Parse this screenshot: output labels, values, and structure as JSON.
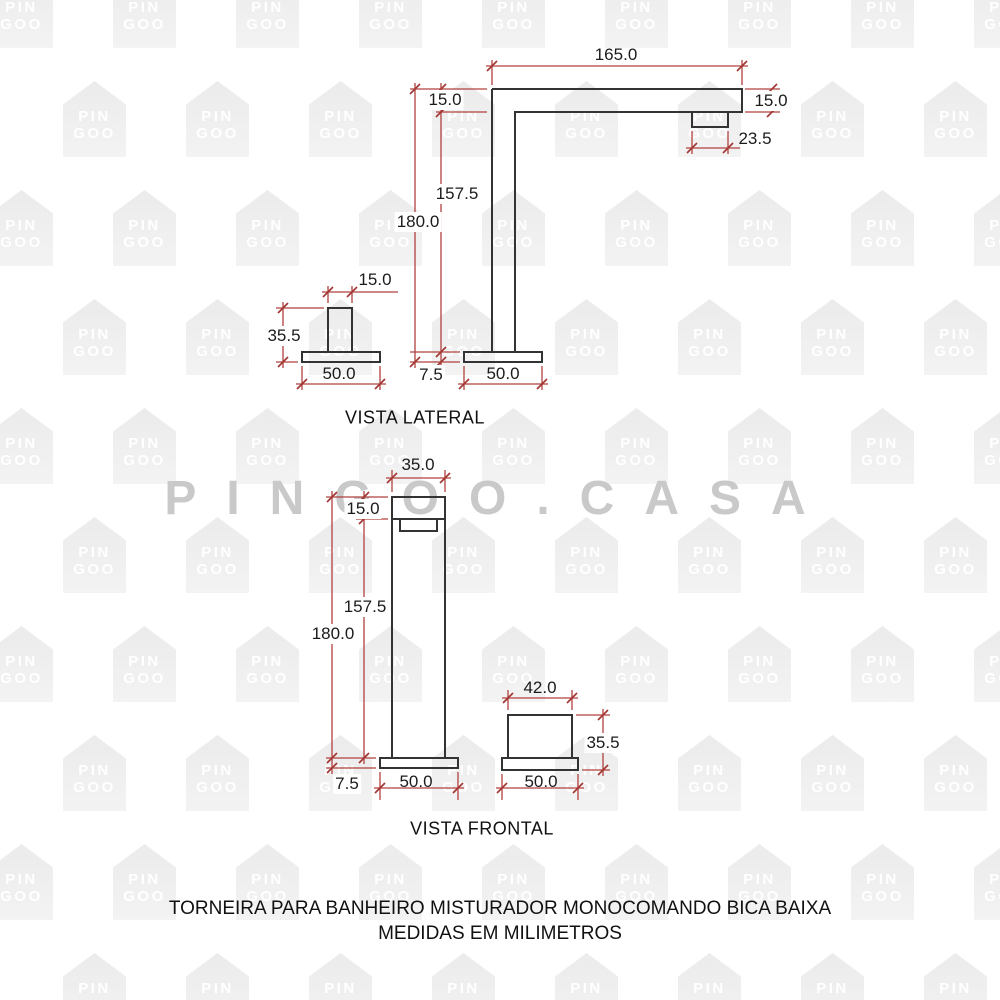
{
  "watermark": {
    "house_line1": "PIN",
    "house_line2": "GOO",
    "big_text": "PINGOO.CASA"
  },
  "lateral": {
    "title": "VISTA LATERAL",
    "dims": {
      "top_length": "165.0",
      "arm_thickness_left": "15.0",
      "arm_thickness_right": "15.0",
      "spout_length": "23.5",
      "height_inner": "157.5",
      "height_total": "180.0",
      "handle_width": "15.0",
      "handle_height": "35.5",
      "handle_base_width": "50.0",
      "base_height": "7.5",
      "base_width": "50.0"
    }
  },
  "frontal": {
    "title": "VISTA FRONTAL",
    "dims": {
      "body_width": "35.0",
      "top_section": "15.0",
      "height_inner": "157.5",
      "height_total": "180.0",
      "base_height": "7.5",
      "base_width": "50.0",
      "handle_width": "42.0",
      "handle_height": "35.5",
      "handle_base_width": "50.0"
    }
  },
  "footer": {
    "line1": "TORNEIRA PARA BANHEIRO MISTURADOR MONOCOMANDO BICA BAIXA",
    "line2": "MEDIDAS EM MILIMETROS"
  },
  "colors": {
    "outline": "#333333",
    "dimension_line": "#b0423f",
    "dimension_tick": "#a23734",
    "dimension_text": "#1b1b1b",
    "watermark_fill": "#ebebeb",
    "watermark_text": "#ffffff",
    "big_watermark_text": "#c9c9c9"
  }
}
